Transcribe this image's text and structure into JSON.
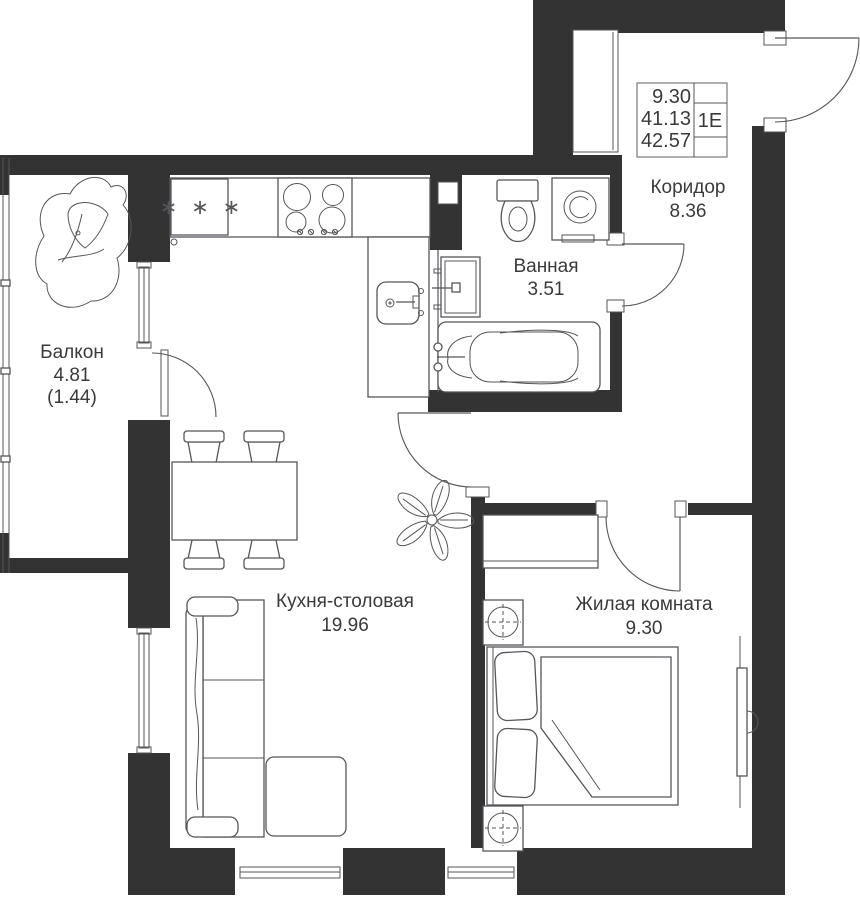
{
  "colors": {
    "wall": "#333333",
    "line": "#55565a",
    "text": "#3a3a3c",
    "bg": "#ffffff"
  },
  "info_box": {
    "living_area": "9.30",
    "area_without_balcony": "41.13",
    "total_area": "42.57",
    "unit_type": "1Е"
  },
  "rooms": {
    "balcony": {
      "name": "Балкон",
      "area": "4.81",
      "area_coefficient": "(1.44)"
    },
    "kitchen_dining": {
      "name": "Кухня-столовая",
      "area": "19.96"
    },
    "bathroom": {
      "name": "Ванная",
      "area": "3.51"
    },
    "corridor": {
      "name": "Коридор",
      "area": "8.36"
    },
    "living_room": {
      "name": "Жилая комната",
      "area": "9.30"
    }
  },
  "icons": {
    "fridge_marks": "∗ ∗ ∗"
  }
}
